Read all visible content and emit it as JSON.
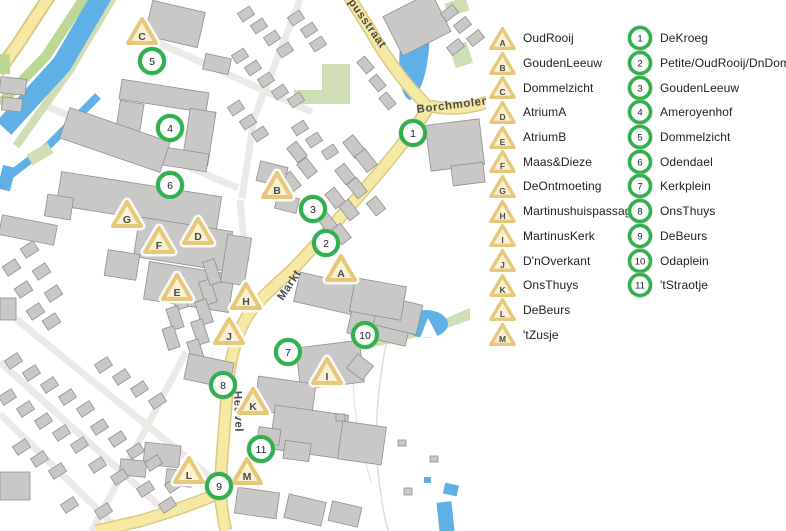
{
  "legend": {
    "letter_items": [
      {
        "id": "A",
        "label": "OudRooij"
      },
      {
        "id": "B",
        "label": "GoudenLeeuw"
      },
      {
        "id": "C",
        "label": "Dommelzicht"
      },
      {
        "id": "D",
        "label": "AtriumA"
      },
      {
        "id": "E",
        "label": "AtriumB"
      },
      {
        "id": "F",
        "label": "Maas&Dieze"
      },
      {
        "id": "G",
        "label": "DeOntmoeting"
      },
      {
        "id": "H",
        "label": "Martinushuispassage"
      },
      {
        "id": "I",
        "label": "MartinusKerk"
      },
      {
        "id": "J",
        "label": "D'nOverkant"
      },
      {
        "id": "K",
        "label": "OnsThuys"
      },
      {
        "id": "L",
        "label": "DeBeurs"
      },
      {
        "id": "M",
        "label": "'tZusje"
      }
    ],
    "number_items": [
      {
        "id": "1",
        "label": "DeKroeg"
      },
      {
        "id": "2",
        "label": "Petite/OudRooij/DnDommel"
      },
      {
        "id": "3",
        "label": "GoudenLeeuw"
      },
      {
        "id": "4",
        "label": "Ameroyenhof"
      },
      {
        "id": "5",
        "label": "Dommelzicht"
      },
      {
        "id": "6",
        "label": "Odendael"
      },
      {
        "id": "7",
        "label": "Kerkplein"
      },
      {
        "id": "8",
        "label": "OnsThuys"
      },
      {
        "id": "9",
        "label": "DeBeurs"
      },
      {
        "id": "10",
        "label": "Odaplein"
      },
      {
        "id": "11",
        "label": "'tStraotje"
      }
    ]
  },
  "map": {
    "street_labels": [
      {
        "text": "pusstraat",
        "x": 348,
        "y": 2,
        "rotate": 55
      },
      {
        "text": "Borchmolendijk",
        "x": 417,
        "y": 113,
        "rotate": -7
      },
      {
        "text": "Markt",
        "x": 283,
        "y": 301,
        "rotate": -57
      },
      {
        "text": "Heuvel",
        "x": 234,
        "y": 391,
        "rotate": 88
      }
    ],
    "letter_markers": [
      {
        "id": "A",
        "x": 341,
        "y": 268
      },
      {
        "id": "B",
        "x": 277,
        "y": 185
      },
      {
        "id": "C",
        "x": 142,
        "y": 31
      },
      {
        "id": "D",
        "x": 198,
        "y": 231
      },
      {
        "id": "E",
        "x": 177,
        "y": 287
      },
      {
        "id": "F",
        "x": 159,
        "y": 240
      },
      {
        "id": "G",
        "x": 127,
        "y": 214
      },
      {
        "id": "H",
        "x": 246,
        "y": 296
      },
      {
        "id": "I",
        "x": 327,
        "y": 371
      },
      {
        "id": "J",
        "x": 229,
        "y": 331
      },
      {
        "id": "K",
        "x": 253,
        "y": 401
      },
      {
        "id": "L",
        "x": 189,
        "y": 470
      },
      {
        "id": "M",
        "x": 247,
        "y": 471
      }
    ],
    "number_markers": [
      {
        "id": "1",
        "x": 413,
        "y": 133
      },
      {
        "id": "2",
        "x": 326,
        "y": 243
      },
      {
        "id": "3",
        "x": 313,
        "y": 209
      },
      {
        "id": "4",
        "x": 170,
        "y": 128
      },
      {
        "id": "5",
        "x": 152,
        "y": 61
      },
      {
        "id": "6",
        "x": 170,
        "y": 185
      },
      {
        "id": "7",
        "x": 288,
        "y": 352
      },
      {
        "id": "8",
        "x": 223,
        "y": 385
      },
      {
        "id": "9",
        "x": 219,
        "y": 486
      },
      {
        "id": "10",
        "x": 365,
        "y": 335
      },
      {
        "id": "11",
        "x": 261,
        "y": 449
      }
    ],
    "colors": {
      "circle_stroke": "#2eb24b",
      "tri_stroke": "#e7c87a",
      "tri_fill": "#fbf2d6",
      "water": "#5fb0e6",
      "green_bright": "#bdd795",
      "green_sage": "#cfdeb4",
      "road_fill": "#f6e9a4",
      "road_casing": "#dcc983",
      "building_fill": "#c9c8c6",
      "building_stroke": "#8f8f8d",
      "street": "#eceae6",
      "label": "#4c4b49"
    }
  }
}
